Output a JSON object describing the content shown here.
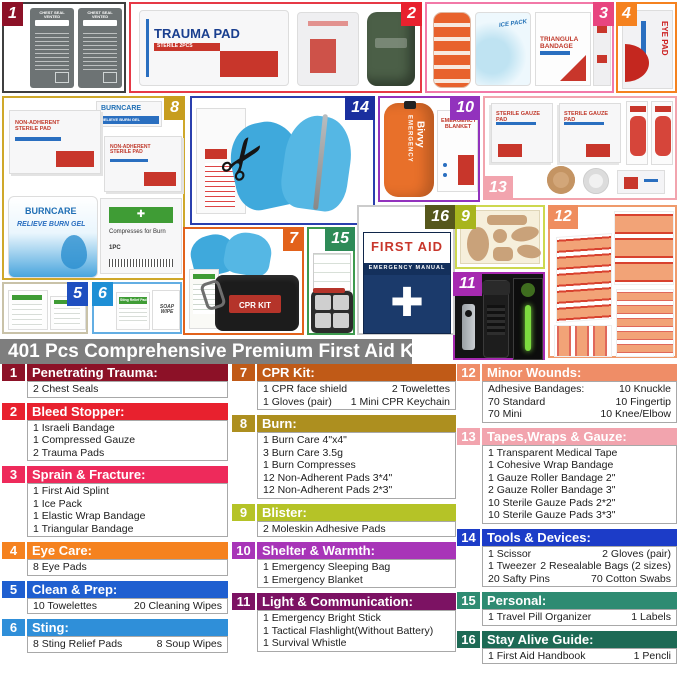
{
  "title": "401 Pcs Comprehensive Premium First Aid Kit",
  "icons": {
    "cross": "✚",
    "scissors": "✂"
  },
  "collage": {
    "box1": {
      "num": "1",
      "tag_color": "#8c1127",
      "border": "#3f3f3f",
      "seal_label": "CHEST SEAL VENTED"
    },
    "box2": {
      "num": "2",
      "tag_color": "#e8212e",
      "border": "#e63946",
      "trauma_label": "TRAUMA PAD",
      "trauma_sub": "STERILE 2PCS"
    },
    "box3": {
      "num": "3",
      "tag_color": "#e8457f",
      "border": "#f279a8",
      "ice_label": "ICE PACK",
      "triangle_label": "TRIANGULA BANDAGE"
    },
    "box4": {
      "num": "4",
      "tag_color": "#f5821f",
      "border": "#f5821f",
      "label": "EYE PAD"
    },
    "box5": {
      "num": "5",
      "tag_color": "#1f4fc0",
      "border": "#c9c2a8"
    },
    "box6": {
      "num": "6",
      "tag_color": "#1e8fd5",
      "border": "#63aee3",
      "sting_label": "Sting Relief Pad",
      "soap_label": "SOAP WIPE"
    },
    "box7": {
      "num": "7",
      "tag_color": "#e2621b",
      "border": "#e2621b",
      "pouch_label": "CPR KIT"
    },
    "box8": {
      "num": "8",
      "tag_color": "#c79d1e",
      "border": "#cfa82a",
      "gel_box_brand": "BURNCARE",
      "gel_box_sub": "RELIEVE BURN GEL",
      "pad_label": "NON-ADHERENT STERILE PAD",
      "pouch_brand": "BURNCARE",
      "pouch_sub": "RELIEVE BURN GEL",
      "compress_label": "Compresses for Burn",
      "compress_count": "1PC"
    },
    "box9": {
      "num": "9",
      "tag_color": "#a8b51d",
      "border": "#cdd84f"
    },
    "box10": {
      "num": "10",
      "tag_color": "#9232bd",
      "border": "#9232bd",
      "bivvy_line1": "EMERGENCY",
      "bivvy_line2": "Bivvy",
      "blanket_label": "EMERGENCY BLANKET"
    },
    "box11": {
      "num": "11",
      "tag_color": "#a62ab0",
      "border": "#a62ab0"
    },
    "box12": {
      "num": "12",
      "tag_color": "#ef8d5e",
      "border": "#ef9a6b"
    },
    "box13": {
      "num": "13",
      "tag_color": "#f2a4ae",
      "border": "#f2a4ae",
      "gauze_label": "STERILE GAUZE PAD"
    },
    "box14": {
      "num": "14",
      "tag_color": "#1a2f9f",
      "border": "#2a3fae"
    },
    "box15": {
      "num": "15",
      "tag_color": "#2e8b57",
      "border": "#3d9a4e"
    },
    "box16": {
      "num": "16",
      "tag_color": "#56571c",
      "border": "#cccccc",
      "book_title": "FIRST AID",
      "book_sub": "EMERGENCY MANUAL"
    }
  },
  "sections": {
    "left": [
      {
        "num": "1",
        "label": "Penetrating Trauma:",
        "color": "#8c1127",
        "rows": [
          [
            "2 Chest Seals"
          ]
        ]
      },
      {
        "num": "2",
        "label": "Bleed Stopper:",
        "color": "#e8212e",
        "rows": [
          [
            "1 Israeli Bandage"
          ],
          [
            "1 Compressed Gauze"
          ],
          [
            "2 Trauma Pads"
          ]
        ]
      },
      {
        "num": "3",
        "label": "Sprain & Fracture:",
        "color": "#ee2a5b",
        "rows": [
          [
            "1 First Aid Splint"
          ],
          [
            "1 Ice Pack"
          ],
          [
            "1 Elastic Wrap Bandage"
          ],
          [
            "1 Triangular Bandage"
          ]
        ]
      },
      {
        "num": "4",
        "label": "Eye Care:",
        "color": "#f5821f",
        "rows": [
          [
            "8 Eye Pads"
          ]
        ]
      },
      {
        "num": "5",
        "label": "Clean & Prep:",
        "color": "#1f5fd0",
        "rows": [
          [
            "10 Towelettes",
            "20 Cleaning Wipes"
          ]
        ]
      },
      {
        "num": "6",
        "label": "Sting:",
        "color": "#2f8fd9",
        "rows": [
          [
            "8 Sting Relief Pads",
            "8 Soup Wipes"
          ]
        ]
      }
    ],
    "middle": [
      {
        "num": "7",
        "label": "CPR Kit:",
        "color": "#c05a17",
        "rows": [
          [
            "1 CPR face shield",
            "2 Towelettes"
          ],
          [
            "1 Gloves (pair)",
            "1 Mini CPR Keychain"
          ]
        ]
      },
      {
        "num": "8",
        "label": "Burn:",
        "color": "#ad8f1f",
        "rows": [
          [
            "1 Burn Care 4\"x4\""
          ],
          [
            "3 Burn Care 3.5g"
          ],
          [
            "1 Burn Compresses"
          ],
          [
            "12 Non-Adherent Pads 3*4\""
          ],
          [
            "12 Non-Adherent Pads 2*3\""
          ]
        ]
      },
      {
        "num": "9",
        "label": "Blister:",
        "color": "#b5c327",
        "rows": [
          [
            "2 Moleskin Adhesive Pads"
          ]
        ]
      },
      {
        "num": "10",
        "label": "Shelter & Warmth:",
        "color": "#a835b8",
        "rows": [
          [
            "1 Emergency Sleeping Bag"
          ],
          [
            "1 Emergency Blanket"
          ]
        ]
      },
      {
        "num": "11",
        "label": "Light & Communication:",
        "color": "#7c1263",
        "rows": [
          [
            "1 Emergency Bright Stick"
          ],
          [
            "1 Tactical Flashlight(Without Battery)"
          ],
          [
            "1 Survival Whistle"
          ]
        ]
      }
    ],
    "right": [
      {
        "num": "12",
        "label": "Minor Wounds:",
        "color": "#ef8d67",
        "rows": [
          [
            "Adhesive Bandages:",
            "10 Knuckle"
          ],
          [
            "70 Standard",
            "10 Fingertip"
          ],
          [
            "70 Mini",
            "10 Knee/Elbow"
          ]
        ]
      },
      {
        "num": "13",
        "label": "Tapes,Wraps & Gauze:",
        "color": "#f2a4ae",
        "rows": [
          [
            "1 Transparent Medical Tape"
          ],
          [
            "1 Cohesive Wrap Bandage"
          ],
          [
            "1 Gauze Roller Bandage 2\""
          ],
          [
            "2 Gauze Roller Bandage 3\""
          ],
          [
            "10 Sterile Gauze Pads 2*2\""
          ],
          [
            "10 Sterile Gauze Pads 3*3\""
          ]
        ]
      },
      {
        "num": "14",
        "label": "Tools & Devices:",
        "color": "#1c3cc8",
        "rows": [
          [
            "1 Scissor",
            "2 Gloves (pair)"
          ],
          [
            "1 Tweezer",
            "2 Resealable Bags (2 sizes)"
          ],
          [
            "20 Safty Pins",
            "70 Cotton Swabs"
          ]
        ]
      },
      {
        "num": "15",
        "label": "Personal:",
        "color": "#2e8b72",
        "rows": [
          [
            "1 Travel Pill Organizer",
            "1 Labels"
          ]
        ]
      },
      {
        "num": "16",
        "label": "Stay Alive Guide:",
        "color": "#1d6a55",
        "rows": [
          [
            "1 First Aid Handbook",
            "1 Pencli"
          ]
        ]
      }
    ]
  }
}
